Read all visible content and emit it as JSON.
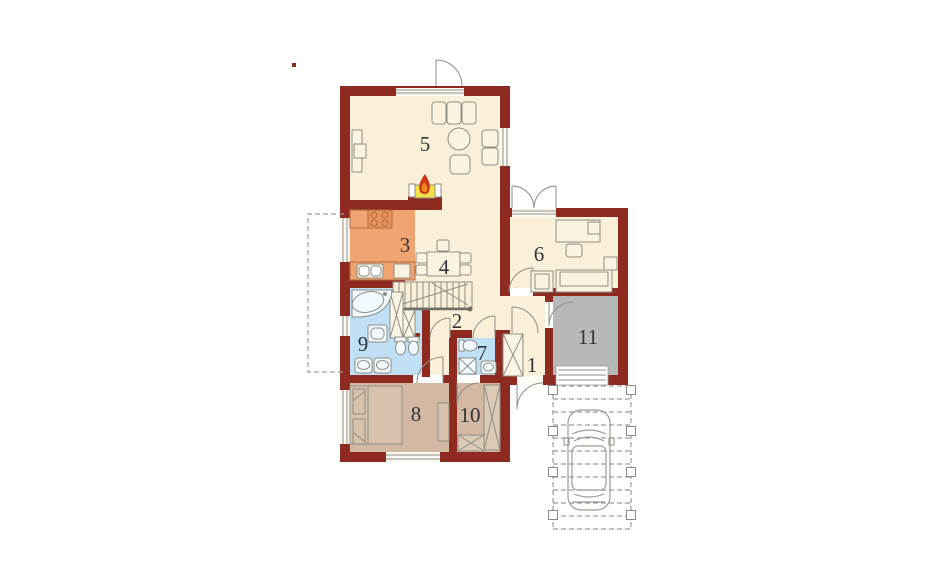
{
  "plan": {
    "background": "#FFFFFF",
    "room_labels": [
      {
        "number": "1"
      },
      {
        "number": "2"
      },
      {
        "number": "3"
      },
      {
        "number": "4"
      },
      {
        "number": "5"
      },
      {
        "number": "6"
      },
      {
        "number": "7"
      },
      {
        "number": "8"
      },
      {
        "number": "9"
      },
      {
        "number": "10"
      },
      {
        "number": "11"
      }
    ],
    "colors": {
      "wall": "#8F2A20",
      "floor_cream": "#FAF0DA",
      "kitchen_orange": "#F0A472",
      "bathroom_blue": "#BFE0F4",
      "bedroom_tan": "#D3B9A4",
      "utility_gray": "#B6B8BA",
      "fireplace_yellow": "#F4E04A",
      "flame_red": "#CC3518",
      "flame_orange": "#F08A1E",
      "furniture_line_gray": "#8E8E84",
      "dashed_line_gray": "#9B9B9B",
      "label_color": "#33333B"
    },
    "icons": [
      "fireplace-icon",
      "stove-icon",
      "kitchen-sink-icon",
      "dining-table-icon",
      "sofa-icon",
      "armchair-icon",
      "round-table-icon",
      "tv-cabinet-icon",
      "stairs-icon",
      "corner-bathtub-icon",
      "washer-icon",
      "washbasin-icon",
      "toilet-icon",
      "shower-icon",
      "double-bed-icon",
      "wardrobe-icon",
      "desk-icon",
      "office-chair-icon",
      "car-top-view-icon",
      "carport-post-icon",
      "terrace-outline",
      "garage-door-icon",
      "door-swing-icon",
      "window-icon"
    ]
  }
}
